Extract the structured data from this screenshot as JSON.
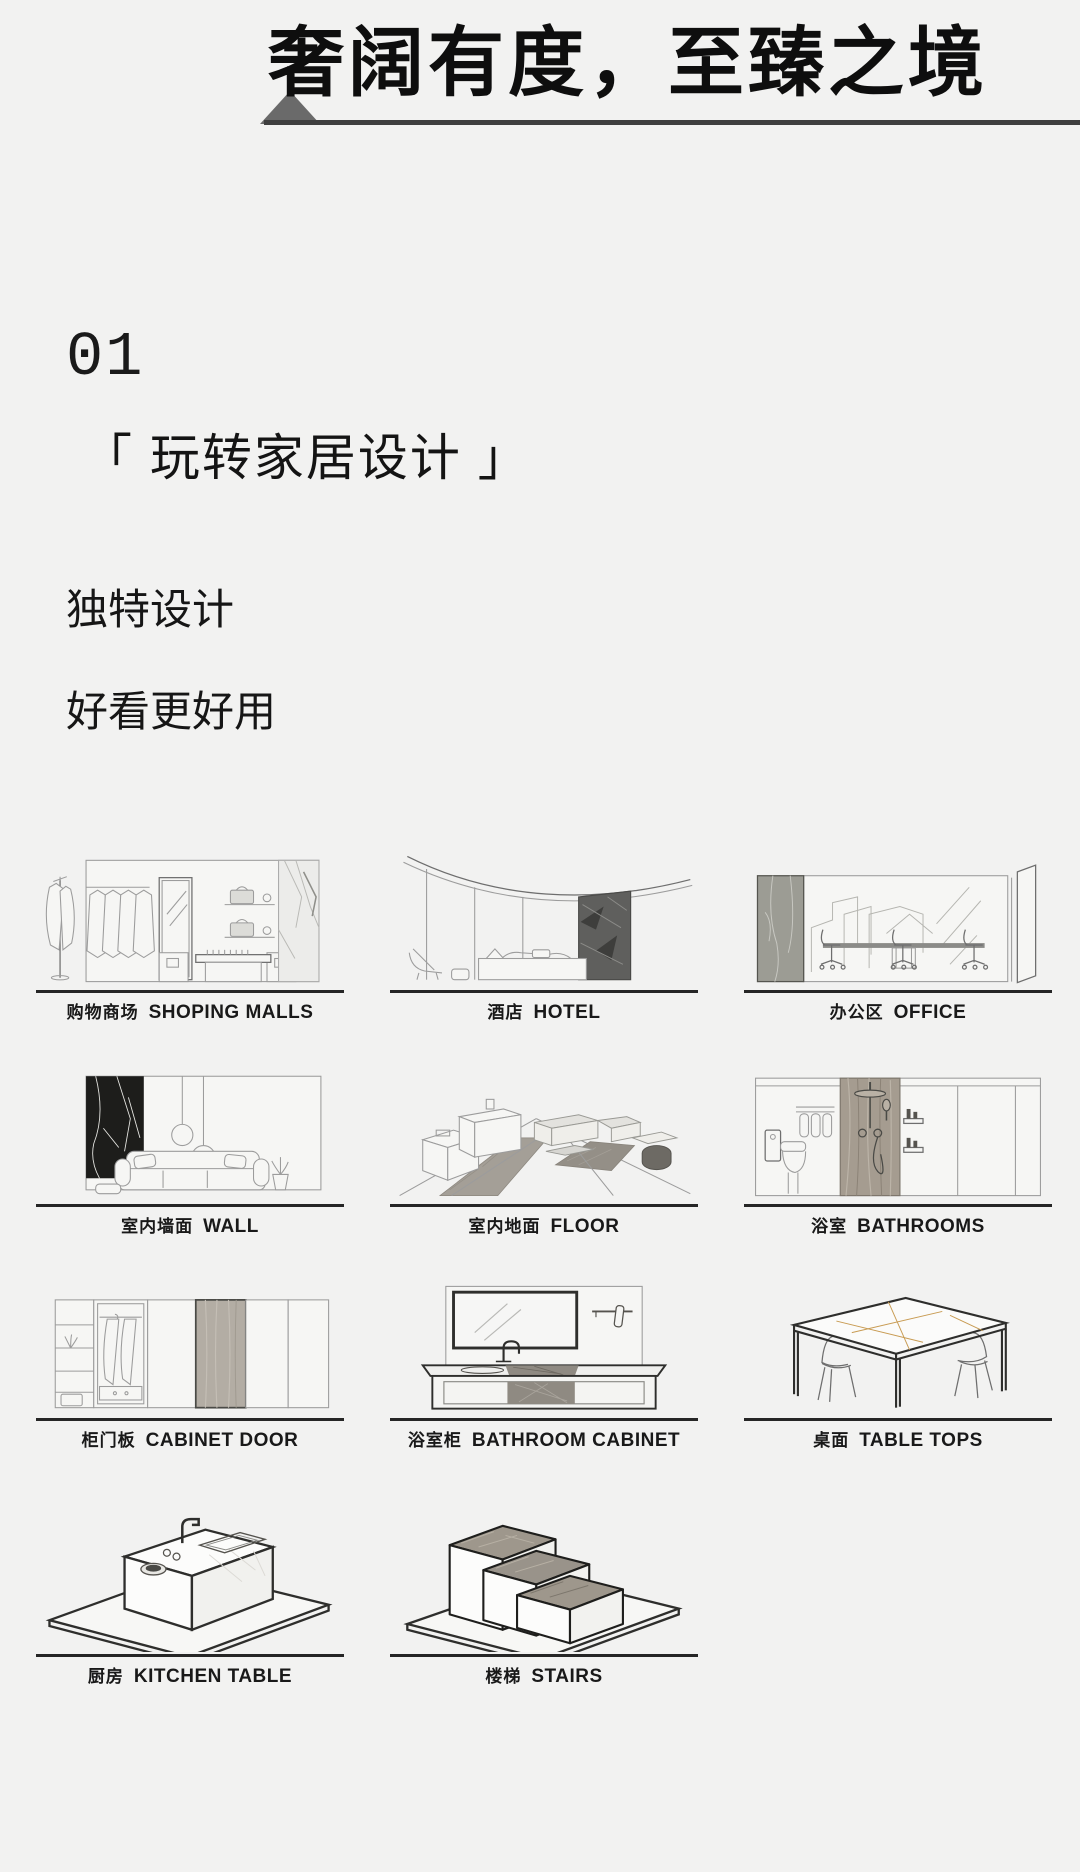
{
  "header": {
    "title": "奢阔有度，至臻之境"
  },
  "section": {
    "number": "01",
    "heading": "「 玩转家居设计 」",
    "line1": "独特设计",
    "line2": "好看更好用"
  },
  "tiles": [
    {
      "zh": "购物商场",
      "en": "SHOPING MALLS",
      "icon": "shopping-mall-illustration"
    },
    {
      "zh": "酒店",
      "en": "HOTEL",
      "icon": "hotel-illustration"
    },
    {
      "zh": "办公区",
      "en": "OFFICE",
      "icon": "office-illustration"
    },
    {
      "zh": "室内墙面",
      "en": "WALL",
      "icon": "wall-illustration"
    },
    {
      "zh": "室内地面",
      "en": "FLOOR",
      "icon": "floor-illustration"
    },
    {
      "zh": "浴室",
      "en": "BATHROOMS",
      "icon": "bathroom-illustration"
    },
    {
      "zh": "柜门板",
      "en": "CABINET DOOR",
      "icon": "cabinet-door-illustration"
    },
    {
      "zh": "浴室柜",
      "en": "BATHROOM CABINET",
      "icon": "bathroom-cabinet-illustration"
    },
    {
      "zh": "桌面",
      "en": "TABLE TOPS",
      "icon": "table-tops-illustration"
    },
    {
      "zh": "厨房",
      "en": "KITCHEN TABLE",
      "icon": "kitchen-table-illustration"
    },
    {
      "zh": "楼梯",
      "en": "STAIRS",
      "icon": "stairs-illustration"
    }
  ],
  "colors": {
    "background": "#f2f2f1",
    "text": "#141414",
    "header_rule": "#3f3f3f",
    "triangle": "#6a6a6a",
    "tile_baseline": "#262626",
    "dark_marble": "#1d1d1b",
    "gray_marble": "#9e978c",
    "taupe_marble": "#a59c90",
    "wood_panel": "#b3ada4",
    "gold_vein": "#c89b52"
  }
}
